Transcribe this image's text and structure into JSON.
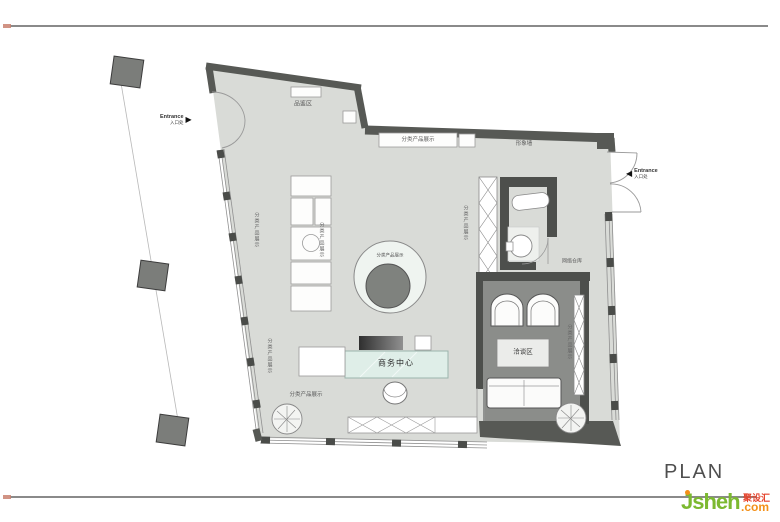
{
  "colors": {
    "wall": "#575955",
    "floor": "#d9dbd7",
    "meeting_floor": "#8b8d8a",
    "desk_teal": "#dfeee8",
    "brand_green": "#7cb930",
    "brand_orange": "#f39019",
    "brand_red": "#e5432c"
  },
  "footer": {
    "plan_title": "PLAN"
  },
  "logo": {
    "brand": "Jsheh",
    "suffix": ".com",
    "badge": "聚设汇"
  },
  "plan": {
    "labels": {
      "tasting_area": "品鉴区",
      "display_top": "分类产品展示",
      "image_wall": "形象墙",
      "display_circle": "分类产品展示",
      "business_center": "商务中心",
      "meeting_area": "洽谈区",
      "network_storage": "网络仓库",
      "display_bottom": "分类产品展示",
      "display_left_upper": "分类产品展示",
      "display_left_lower": "分类产品展示",
      "display_shelf_left": "分类产品展示",
      "display_partition": "分类产品展示",
      "display_right": "分类产品展示"
    },
    "entrance_left": {
      "en": "Entrance",
      "zh": "入口处"
    },
    "entrance_right": {
      "en": "Entrance",
      "zh": "入口处"
    }
  }
}
